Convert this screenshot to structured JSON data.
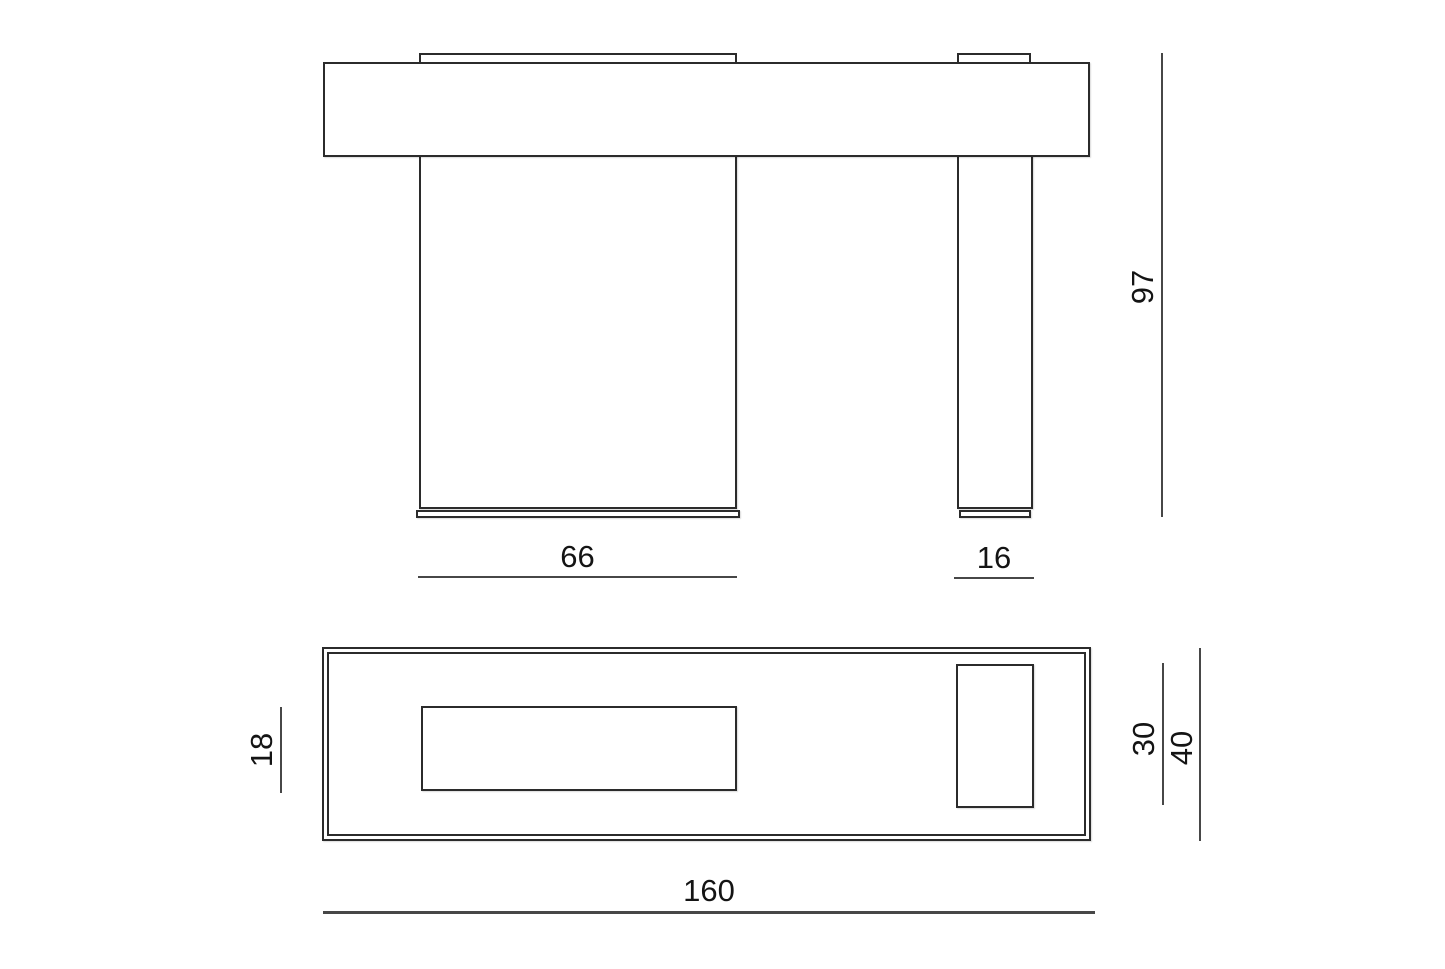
{
  "drawing": {
    "type": "furniture-technical-drawing",
    "views": {
      "front_elevation": {
        "description": "front view: top slab over one wide panel leg and one narrow leg",
        "dimensions": {
          "left_leg_width": "66",
          "right_leg_width": "16",
          "total_height": "97"
        }
      },
      "top_plan": {
        "description": "plan view: outlined top with two leg cross-sections",
        "dimensions": {
          "left_leg_depth": "18",
          "right_leg_depth": "30",
          "total_depth": "40",
          "total_width": "160"
        }
      }
    },
    "colors": {
      "background": "#ffffff",
      "stroke": "#2b2b2b",
      "dimension_line": "#474747",
      "text": "#141414"
    }
  }
}
